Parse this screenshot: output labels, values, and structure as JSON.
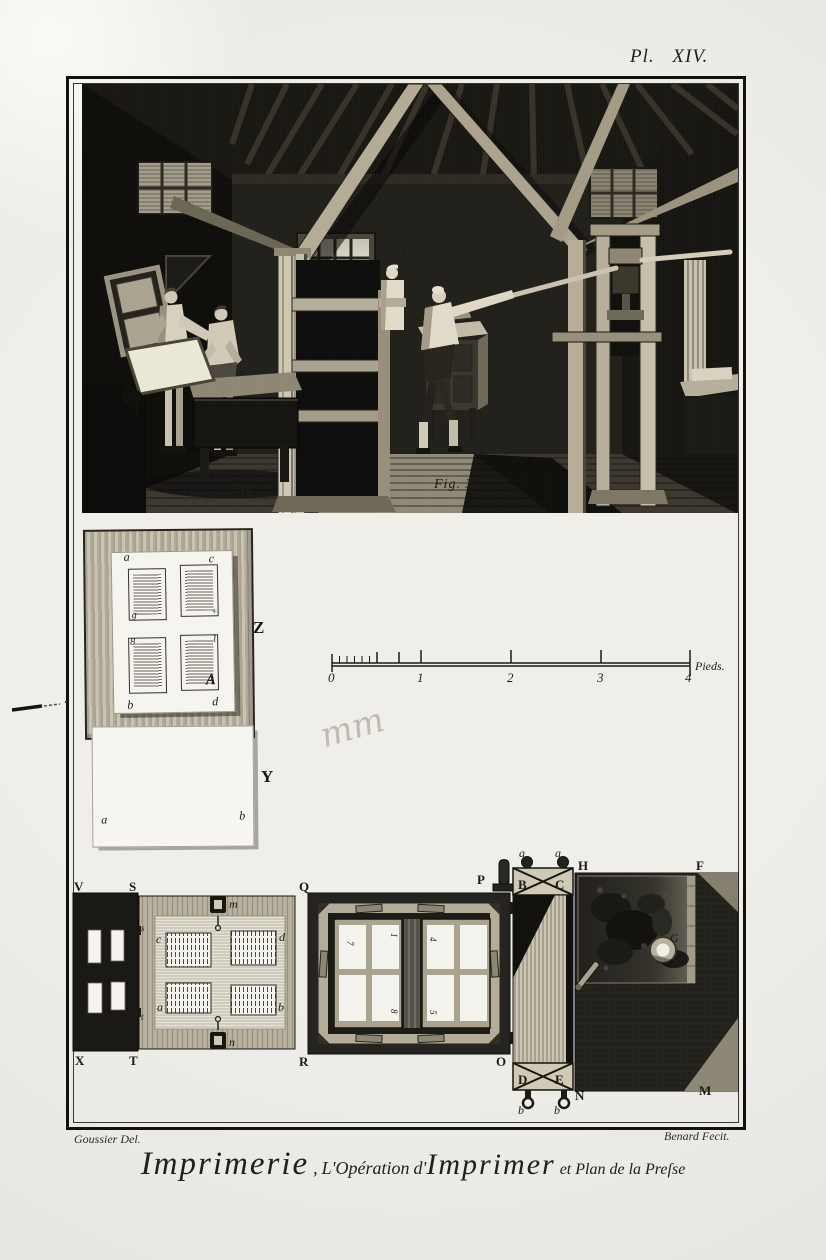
{
  "plate": {
    "number": "Pl. XIV.",
    "credits": {
      "left": "Goussier Del.",
      "right": "Benard Fecit."
    },
    "title": {
      "p1": "Imprimerie",
      "p2": ",",
      "p3": "L'Opération",
      "p4": "d'",
      "p5": "Imprimer",
      "p6": "et Plan de la Preſse"
    }
  },
  "scene": {
    "fig2": "Fig. 2.",
    "fig3": "Fig. 3.",
    "fig4": "Fig. 4."
  },
  "forme_sheet": {
    "label": "Z",
    "corners": {
      "a": "a",
      "c": "c",
      "b": "b",
      "d": "d"
    },
    "marks": {
      "tl": "g",
      "tr": "+",
      "bl": "8",
      "br_num": "1",
      "br_sig": "A"
    }
  },
  "blank_sheet": {
    "label": "Y",
    "corners": {
      "a": "a",
      "b": "b"
    }
  },
  "annotations": {
    "pencil": "mm"
  },
  "scale": {
    "unit": "Pieds.",
    "ticks": [
      "0",
      "1",
      "2",
      "3",
      "4"
    ]
  },
  "plan": {
    "frisket": {
      "v": "V",
      "s": "S",
      "x": "X",
      "t": "T"
    },
    "tympan": {
      "q": "Q",
      "r": "R",
      "clamp_top": "m",
      "clamp_bottom": "n",
      "hinge_top": "s",
      "hinge_bottom": "t",
      "pages": {
        "c": "c",
        "d": "d",
        "a": "a",
        "b": "b"
      }
    },
    "chase": {
      "p": "P",
      "o": "O",
      "nums": [
        "7",
        "1",
        "4",
        "8",
        "5"
      ]
    },
    "rail": {
      "b": "B",
      "c": "C",
      "d": "D",
      "e": "E",
      "a1": "a",
      "a2": "a",
      "b1": "b",
      "b2": "b",
      "n": "N"
    },
    "table": {
      "h": "H",
      "f": "F",
      "m": "M",
      "g": "G",
      "l": "L"
    }
  }
}
